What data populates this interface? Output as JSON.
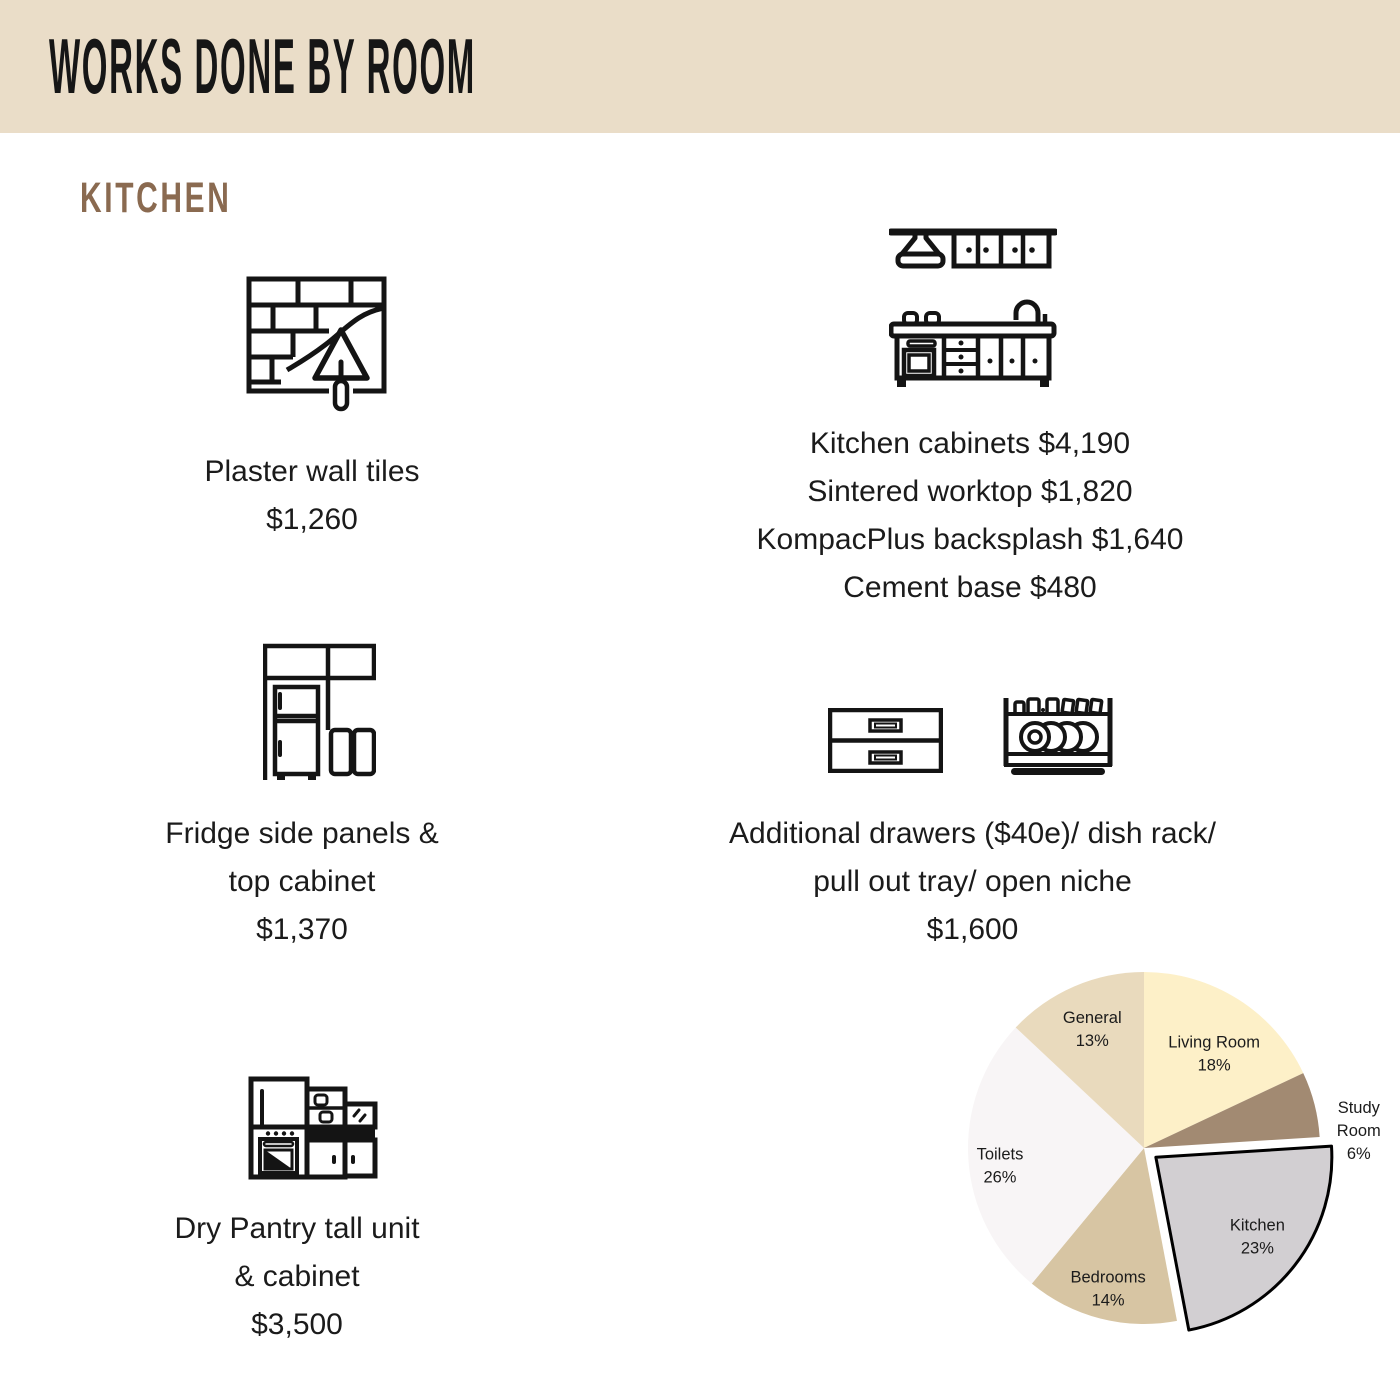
{
  "palette": {
    "header_bg": "#eaddc8",
    "heading_brown": "#8a6a50",
    "icon_stroke": "#141414",
    "text_color": "#1b1b1b"
  },
  "header": {
    "title": "WORKS DONE BY ROOM"
  },
  "section": {
    "title": "KITCHEN"
  },
  "items": [
    {
      "icon": "plaster-trowel-icon",
      "lines": [
        "Plaster wall tiles",
        "$1,260"
      ]
    },
    {
      "icon": "kitchen-cabinets-icon",
      "lines": [
        "Kitchen cabinets $4,190",
        "Sintered worktop $1,820",
        "KompacPlus backsplash $1,640",
        "Cement base $480"
      ]
    },
    {
      "icon": "fridge-cabinet-icon",
      "lines": [
        "Fridge side panels &",
        "top cabinet",
        "$1,370"
      ]
    },
    {
      "icons": [
        "drawers-icon",
        "dish-rack-icon"
      ],
      "lines": [
        "Additional drawers ($40e)/ dish rack/",
        "pull out tray/ open niche",
        "$1,600"
      ]
    },
    {
      "icon": "dry-pantry-icon",
      "lines": [
        "Dry Pantry tall unit",
        "& cabinet",
        "$3,500"
      ]
    }
  ],
  "chart_data": {
    "type": "pie",
    "title": "",
    "legend": "none",
    "labels": "name-and-percent",
    "start_angle_deg": 0,
    "direction": "clockwise",
    "explode_offset": 15,
    "slices": [
      {
        "label": "Living Room",
        "pct": 18,
        "color": "#fdf0c8",
        "label_r": 0.68,
        "label_dx": 6,
        "label_dy": 6
      },
      {
        "label": "Study Room",
        "pct": 6,
        "color": "#a28a72",
        "label_r": 1.26,
        "label_dy": 37,
        "outside": true
      },
      {
        "label": "Kitchen",
        "pct": 23,
        "color": "#d2cfd2",
        "label_r": 0.73,
        "exploded": true,
        "stroke": "#000000"
      },
      {
        "label": "Bedrooms",
        "pct": 14,
        "color": "#d7c5a3",
        "label_r": 0.82
      },
      {
        "label": "Toilets",
        "pct": 26,
        "color": "#f8f5f6",
        "label_r": 0.82,
        "label_dy": 8
      },
      {
        "label": "General",
        "pct": 13,
        "color": "#e9dabd",
        "label_r": 0.74
      }
    ]
  }
}
